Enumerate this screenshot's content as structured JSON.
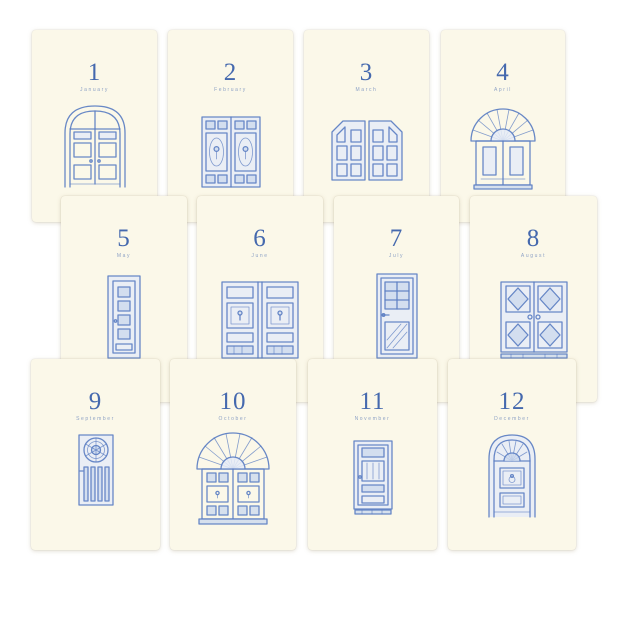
{
  "colors": {
    "background": "#ffffff",
    "card": "#fbf8e9",
    "number_blue": "#4569ae",
    "month_label_blue": "#8fa3c6",
    "door_ink_blue": "#5b7ec2"
  },
  "cards": [
    {
      "number": "1",
      "month": "January",
      "door": "arched-double-door"
    },
    {
      "number": "2",
      "month": "February",
      "door": "ornate-panel-double-door"
    },
    {
      "number": "3",
      "month": "March",
      "door": "six-panel-double-door"
    },
    {
      "number": "4",
      "month": "April",
      "door": "sunburst-fanlight-door"
    },
    {
      "number": "5",
      "month": "May",
      "door": "narrow-four-window-door"
    },
    {
      "number": "6",
      "month": "June",
      "door": "wide-knocker-double-door"
    },
    {
      "number": "7",
      "month": "July",
      "door": "six-pane-window-door"
    },
    {
      "number": "8",
      "month": "August",
      "door": "diamond-panel-double-door"
    },
    {
      "number": "9",
      "month": "September",
      "door": "rosette-slat-door"
    },
    {
      "number": "10",
      "month": "October",
      "door": "fan-arch-double-door"
    },
    {
      "number": "11",
      "month": "November",
      "door": "single-panel-door"
    },
    {
      "number": "12",
      "month": "December",
      "door": "arched-keyhole-door"
    }
  ]
}
